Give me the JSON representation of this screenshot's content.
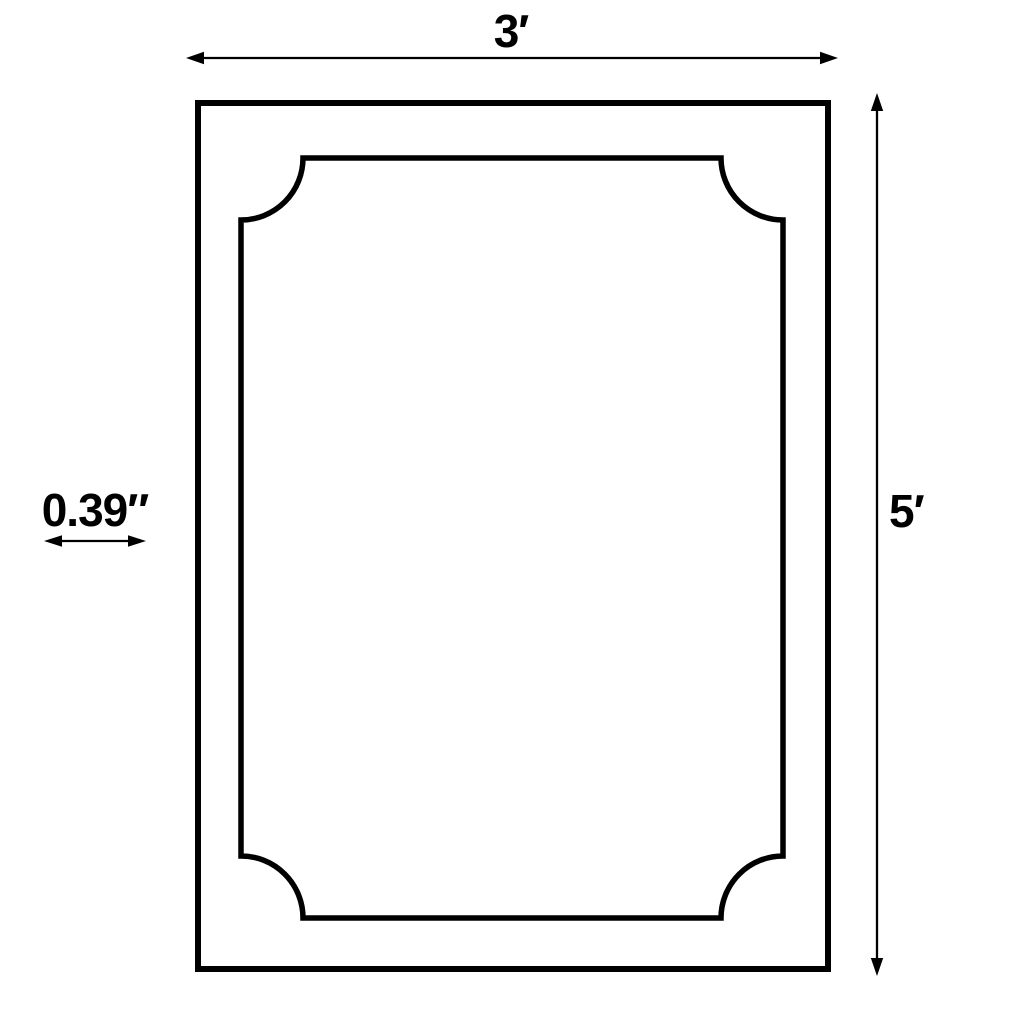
{
  "diagram": {
    "background_color": "#ffffff",
    "line_color": "#000000",
    "labels": {
      "width": "3′",
      "height": "5′",
      "thickness": "0.39″"
    },
    "icons": {
      "width_arrow": "double-headed-horizontal-arrow",
      "height_arrow": "double-headed-vertical-arrow",
      "thickness_arrow": "double-headed-horizontal-arrow"
    }
  }
}
